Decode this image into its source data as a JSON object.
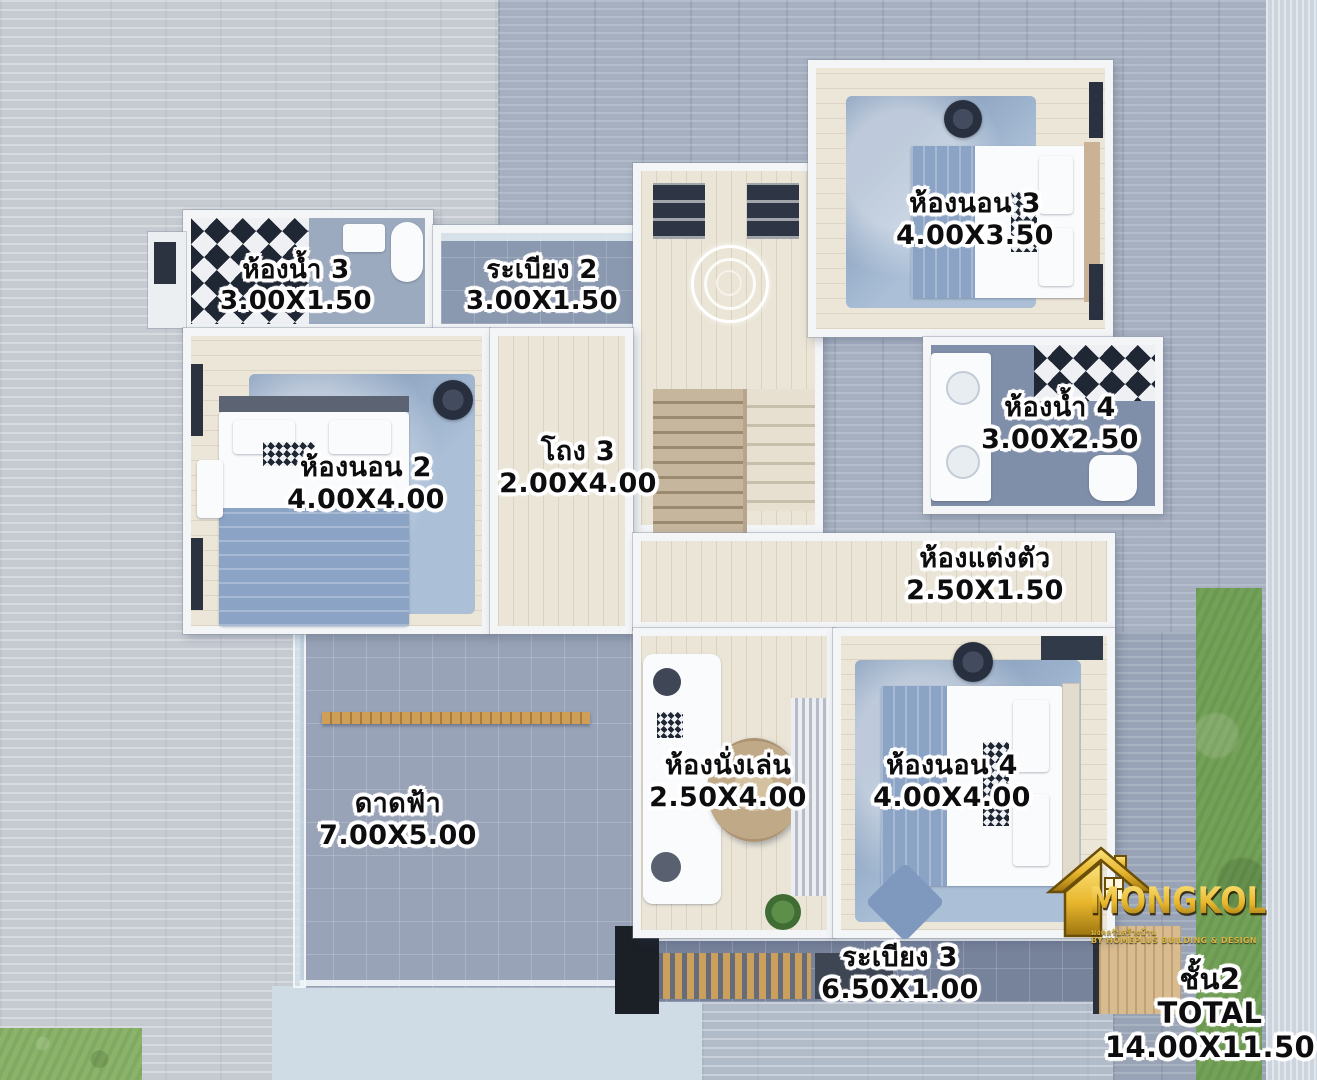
{
  "page": {
    "type": "second-floor-plan-render",
    "floor_title": "ชั้น2"
  },
  "rooms": {
    "bathroom3": {
      "name": "ห้องน้ำ 3",
      "size": "3.00X1.50"
    },
    "balcony2": {
      "name": "ระเบียง 2",
      "size": "3.00X1.50"
    },
    "bedroom3": {
      "name": "ห้องนอน 3",
      "size": "4.00X3.50"
    },
    "bedroom2": {
      "name": "ห้องนอน 2",
      "size": "4.00X4.00"
    },
    "hall3": {
      "name": "โถง 3",
      "size": "2.00X4.00"
    },
    "bathroom4": {
      "name": "ห้องน้ำ 4",
      "size": "3.00X2.50"
    },
    "dressing_room": {
      "name": "ห้องแต่งตัว",
      "size": "2.50X1.50"
    },
    "living_room": {
      "name": "ห้องนั่งเล่น",
      "size": "2.50X4.00"
    },
    "bedroom4": {
      "name": "ห้องนอน 4",
      "size": "4.00X4.00"
    },
    "roof_deck": {
      "name": "ดาดฟ้า",
      "size": "7.00X5.00"
    },
    "balcony3": {
      "name": "ระเบียง 3",
      "size": "6.50X1.00"
    }
  },
  "summary": {
    "floor": "ชั้น2",
    "label": "TOTAL",
    "size": "14.00X11.50"
  },
  "logo": {
    "brand": "MONGKOL",
    "tagline_th": "มงคลรับสร้างบ้าน",
    "tagline_en": "BY HOMEPLUS BUILDING & DESIGN"
  },
  "colors": {
    "label_text": "#0d0d0f",
    "label_outline": "#ffffff",
    "logo_gold": "#e7b52c",
    "grass": "#74a158",
    "deck_tile": "#99a3b7",
    "dark_stone": "#a6b0c1",
    "light_stone": "#c6cbd2",
    "pool": "#cfdbe5",
    "floor_wood": "#ebe5d7"
  }
}
